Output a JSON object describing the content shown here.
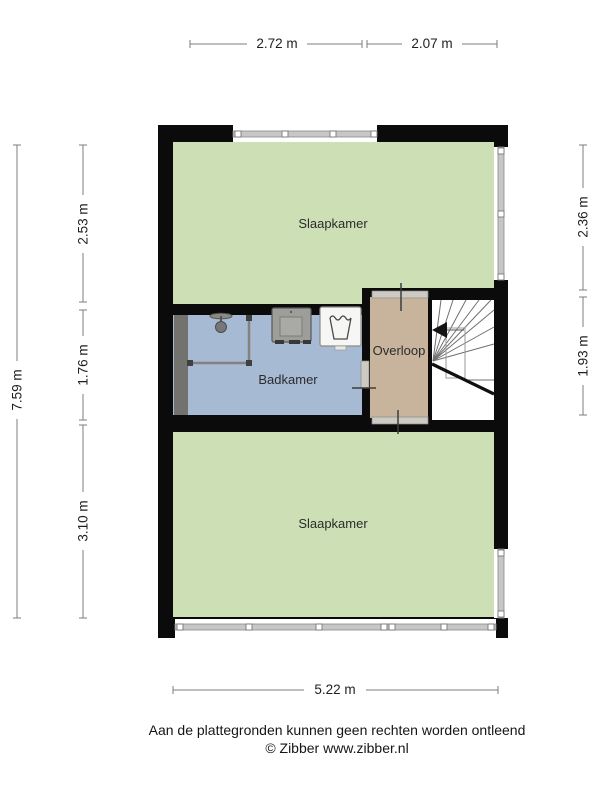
{
  "plan": {
    "rooms": [
      {
        "id": "slaapkamer-top",
        "label": "Slaapkamer"
      },
      {
        "id": "badkamer",
        "label": "Badkamer"
      },
      {
        "id": "overloop",
        "label": "Overloop"
      },
      {
        "id": "slaapkamer-bottom",
        "label": "Slaapkamer"
      }
    ],
    "icons": [
      "shower-icon",
      "sink-vanity-icon",
      "laundry-basket-icon",
      "stair-direction-arrow-icon"
    ]
  },
  "dimensions": {
    "top": [
      "2.72 m",
      "2.07 m"
    ],
    "left_outer": "7.59 m",
    "left_inner": [
      "2.53 m",
      "1.76 m",
      "3.10 m"
    ],
    "right": [
      "2.36 m",
      "1.93 m"
    ],
    "bottom": "5.22 m"
  },
  "footer": {
    "disclaimer": "Aan de plattegronden kunnen geen rechten worden ontleend",
    "credit": "© Zibber www.zibber.nl"
  },
  "colors": {
    "wall": "#0b0b0b",
    "bedroom_green": "#cde0b5",
    "bathroom_blue": "#a6bad3",
    "landing_tan": "#c8b49c",
    "window_gray": "#c7c7c7",
    "dimension_line": "#7c7c7c"
  }
}
